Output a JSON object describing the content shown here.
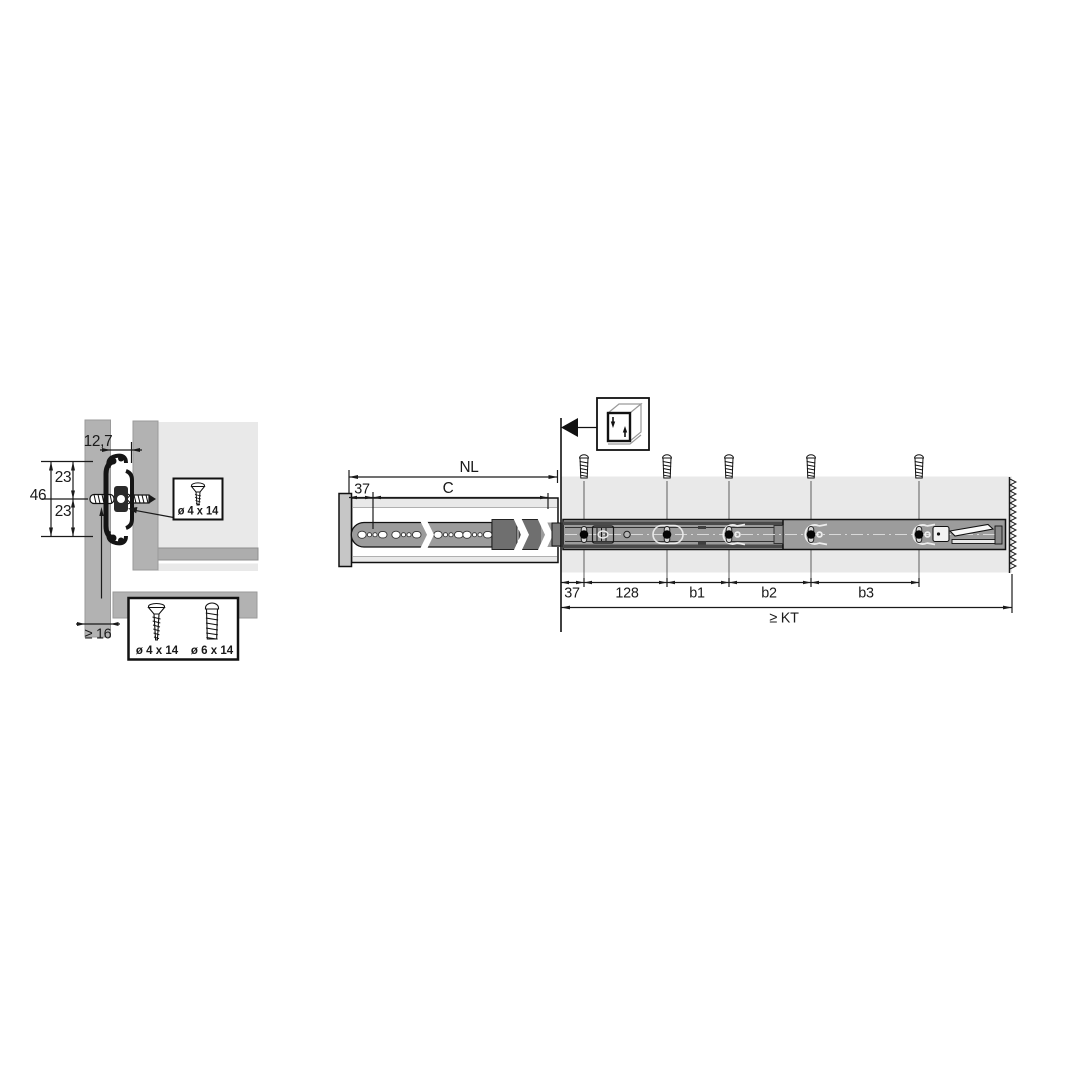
{
  "title": "Drawer slide mounting diagram",
  "colors": {
    "panel_gray": "#b2b2b2",
    "light_gray": "#e9e9e9",
    "rail_gray": "#9c9c9c",
    "dark_gray": "#6f6f6f",
    "line_black": "#1a1a1a"
  },
  "cross_section_view": {
    "offset_label": "12,7",
    "height_total": "46",
    "height_upper": "23",
    "height_lower": "23",
    "panel_min_thickness": "≥ 16",
    "screw_callout": {
      "label": "ø 4 x 14"
    },
    "screw_box": {
      "labels": [
        "ø 4 x 14",
        "ø 6 x 14"
      ]
    }
  },
  "side_view": {
    "nominal_length": "NL",
    "front_hole_offset": "37",
    "hole_span": "C",
    "first_hole": "37",
    "second_spacing": "128",
    "spacing_b1": "b1",
    "spacing_b2": "b2",
    "spacing_b3": "b3",
    "cabinet_depth": "≥ KT"
  }
}
